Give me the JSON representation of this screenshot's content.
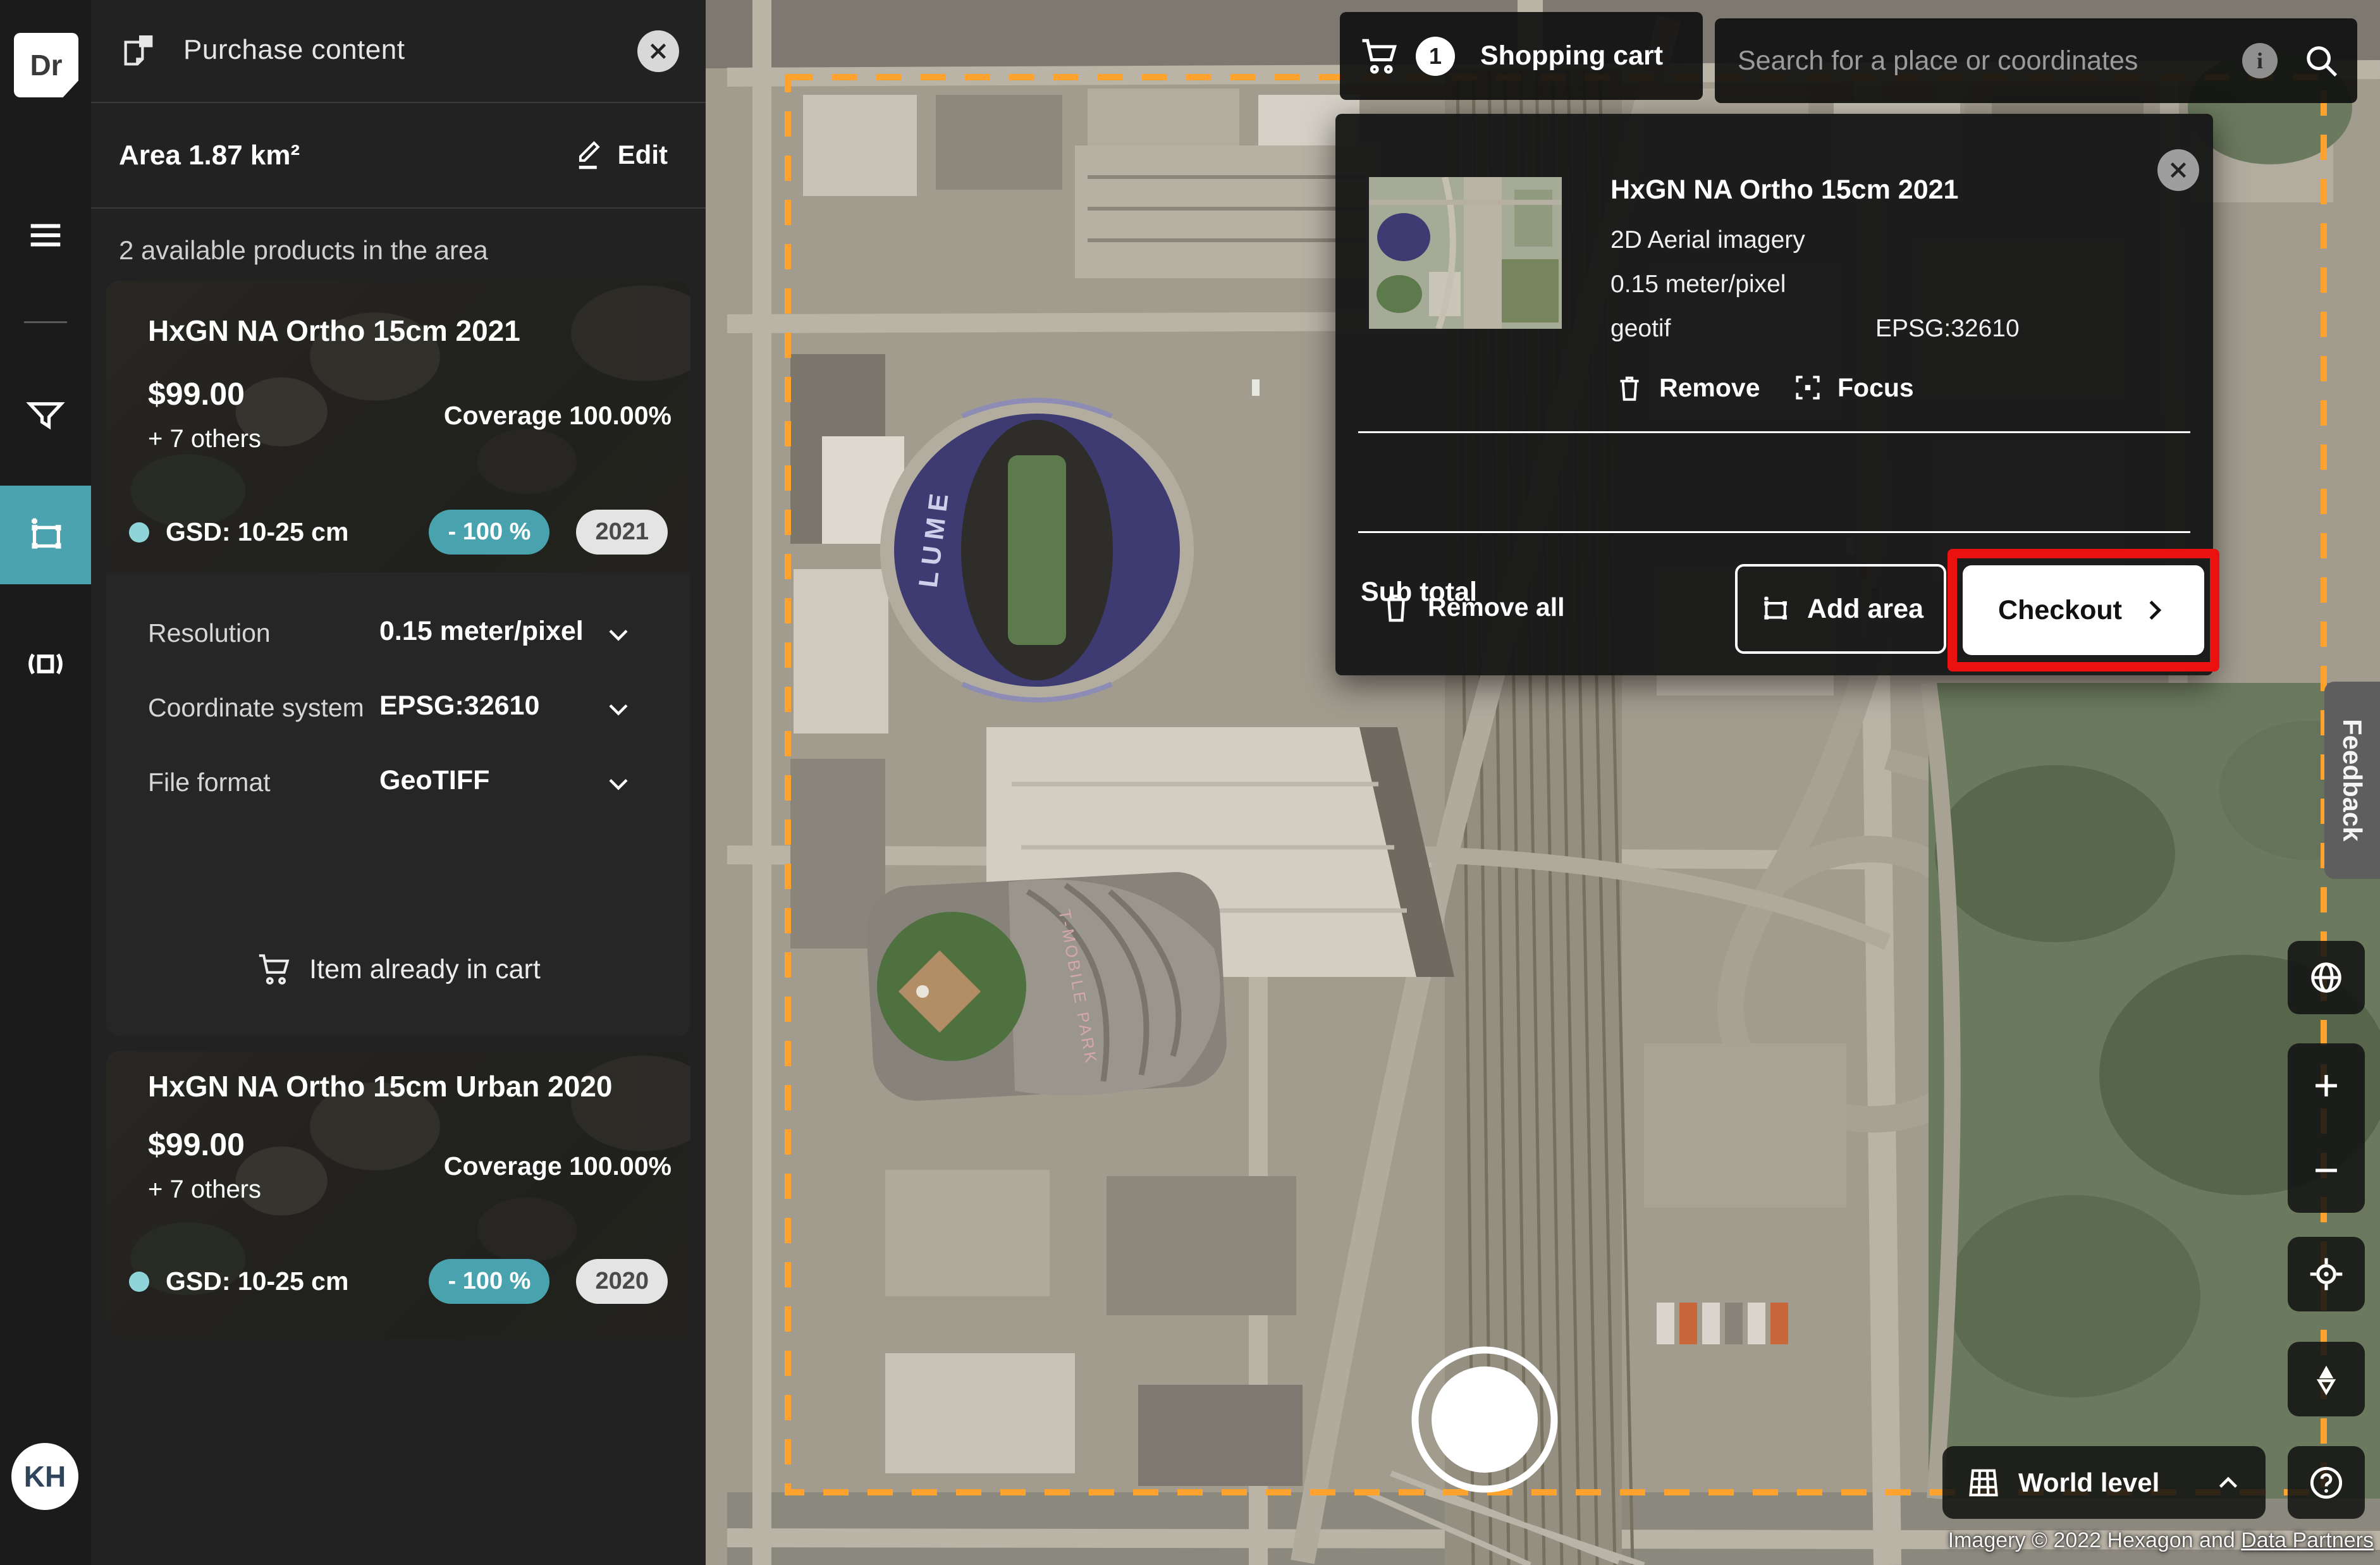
{
  "colors": {
    "accent_teal": "#4aa3ae",
    "badge_dot_teal": "#8fd4d8",
    "selection_orange": "#ffa22e",
    "annotation_red": "#ec1111",
    "panel_bg": "#222222"
  },
  "rail": {
    "logo_text": "Dr",
    "avatar_text": "KH"
  },
  "panel": {
    "title": "Purchase content",
    "area_label": "Area 1.87 km²",
    "edit_label": "Edit",
    "products_heading": "2 available products in the area",
    "cards": [
      {
        "title": "HxGN NA Ortho 15cm 2021",
        "price": "$99.00",
        "others": "+ 7 others",
        "coverage": "Coverage 100.00%",
        "gsd": "GSD: 10-25 cm",
        "discount": "- 100 %",
        "year": "2021"
      },
      {
        "title": "HxGN NA Ortho 15cm Urban 2020",
        "price": "$99.00",
        "others": "+ 7 others",
        "coverage": "Coverage 100.00%",
        "gsd": "GSD: 10-25 cm",
        "discount": "- 100 %",
        "year": "2020"
      }
    ],
    "options": [
      {
        "label": "Resolution",
        "value": "0.15 meter/pixel"
      },
      {
        "label": "Coordinate system",
        "value": "EPSG:32610"
      },
      {
        "label": "File format",
        "value": "GeoTIFF"
      }
    ],
    "cart_status": "Item already in cart"
  },
  "cart": {
    "button_label": "Shopping cart",
    "count": "1",
    "popup": {
      "item": {
        "title": "HxGN NA Ortho 15cm 2021",
        "type": "2D Aerial imagery",
        "resolution": "0.15 meter/pixel",
        "format": "geotif",
        "epsg": "EPSG:32610",
        "remove_label": "Remove",
        "focus_label": "Focus"
      },
      "subtotal_label": "Sub total",
      "subtotal_value": "-",
      "remove_all_label": "Remove all",
      "add_area_label": "Add area",
      "checkout_label": "Checkout"
    }
  },
  "search": {
    "placeholder": "Search for a place or coordinates"
  },
  "right": {
    "feedback": "Feedback",
    "world_level": "World level",
    "attribution_text": "Imagery © 2022 Hexagon and ",
    "attribution_link": "Data Partners"
  },
  "map": {
    "labels": {
      "lumen": "LUME",
      "tmobile": "T-MOBILE PARK"
    }
  }
}
